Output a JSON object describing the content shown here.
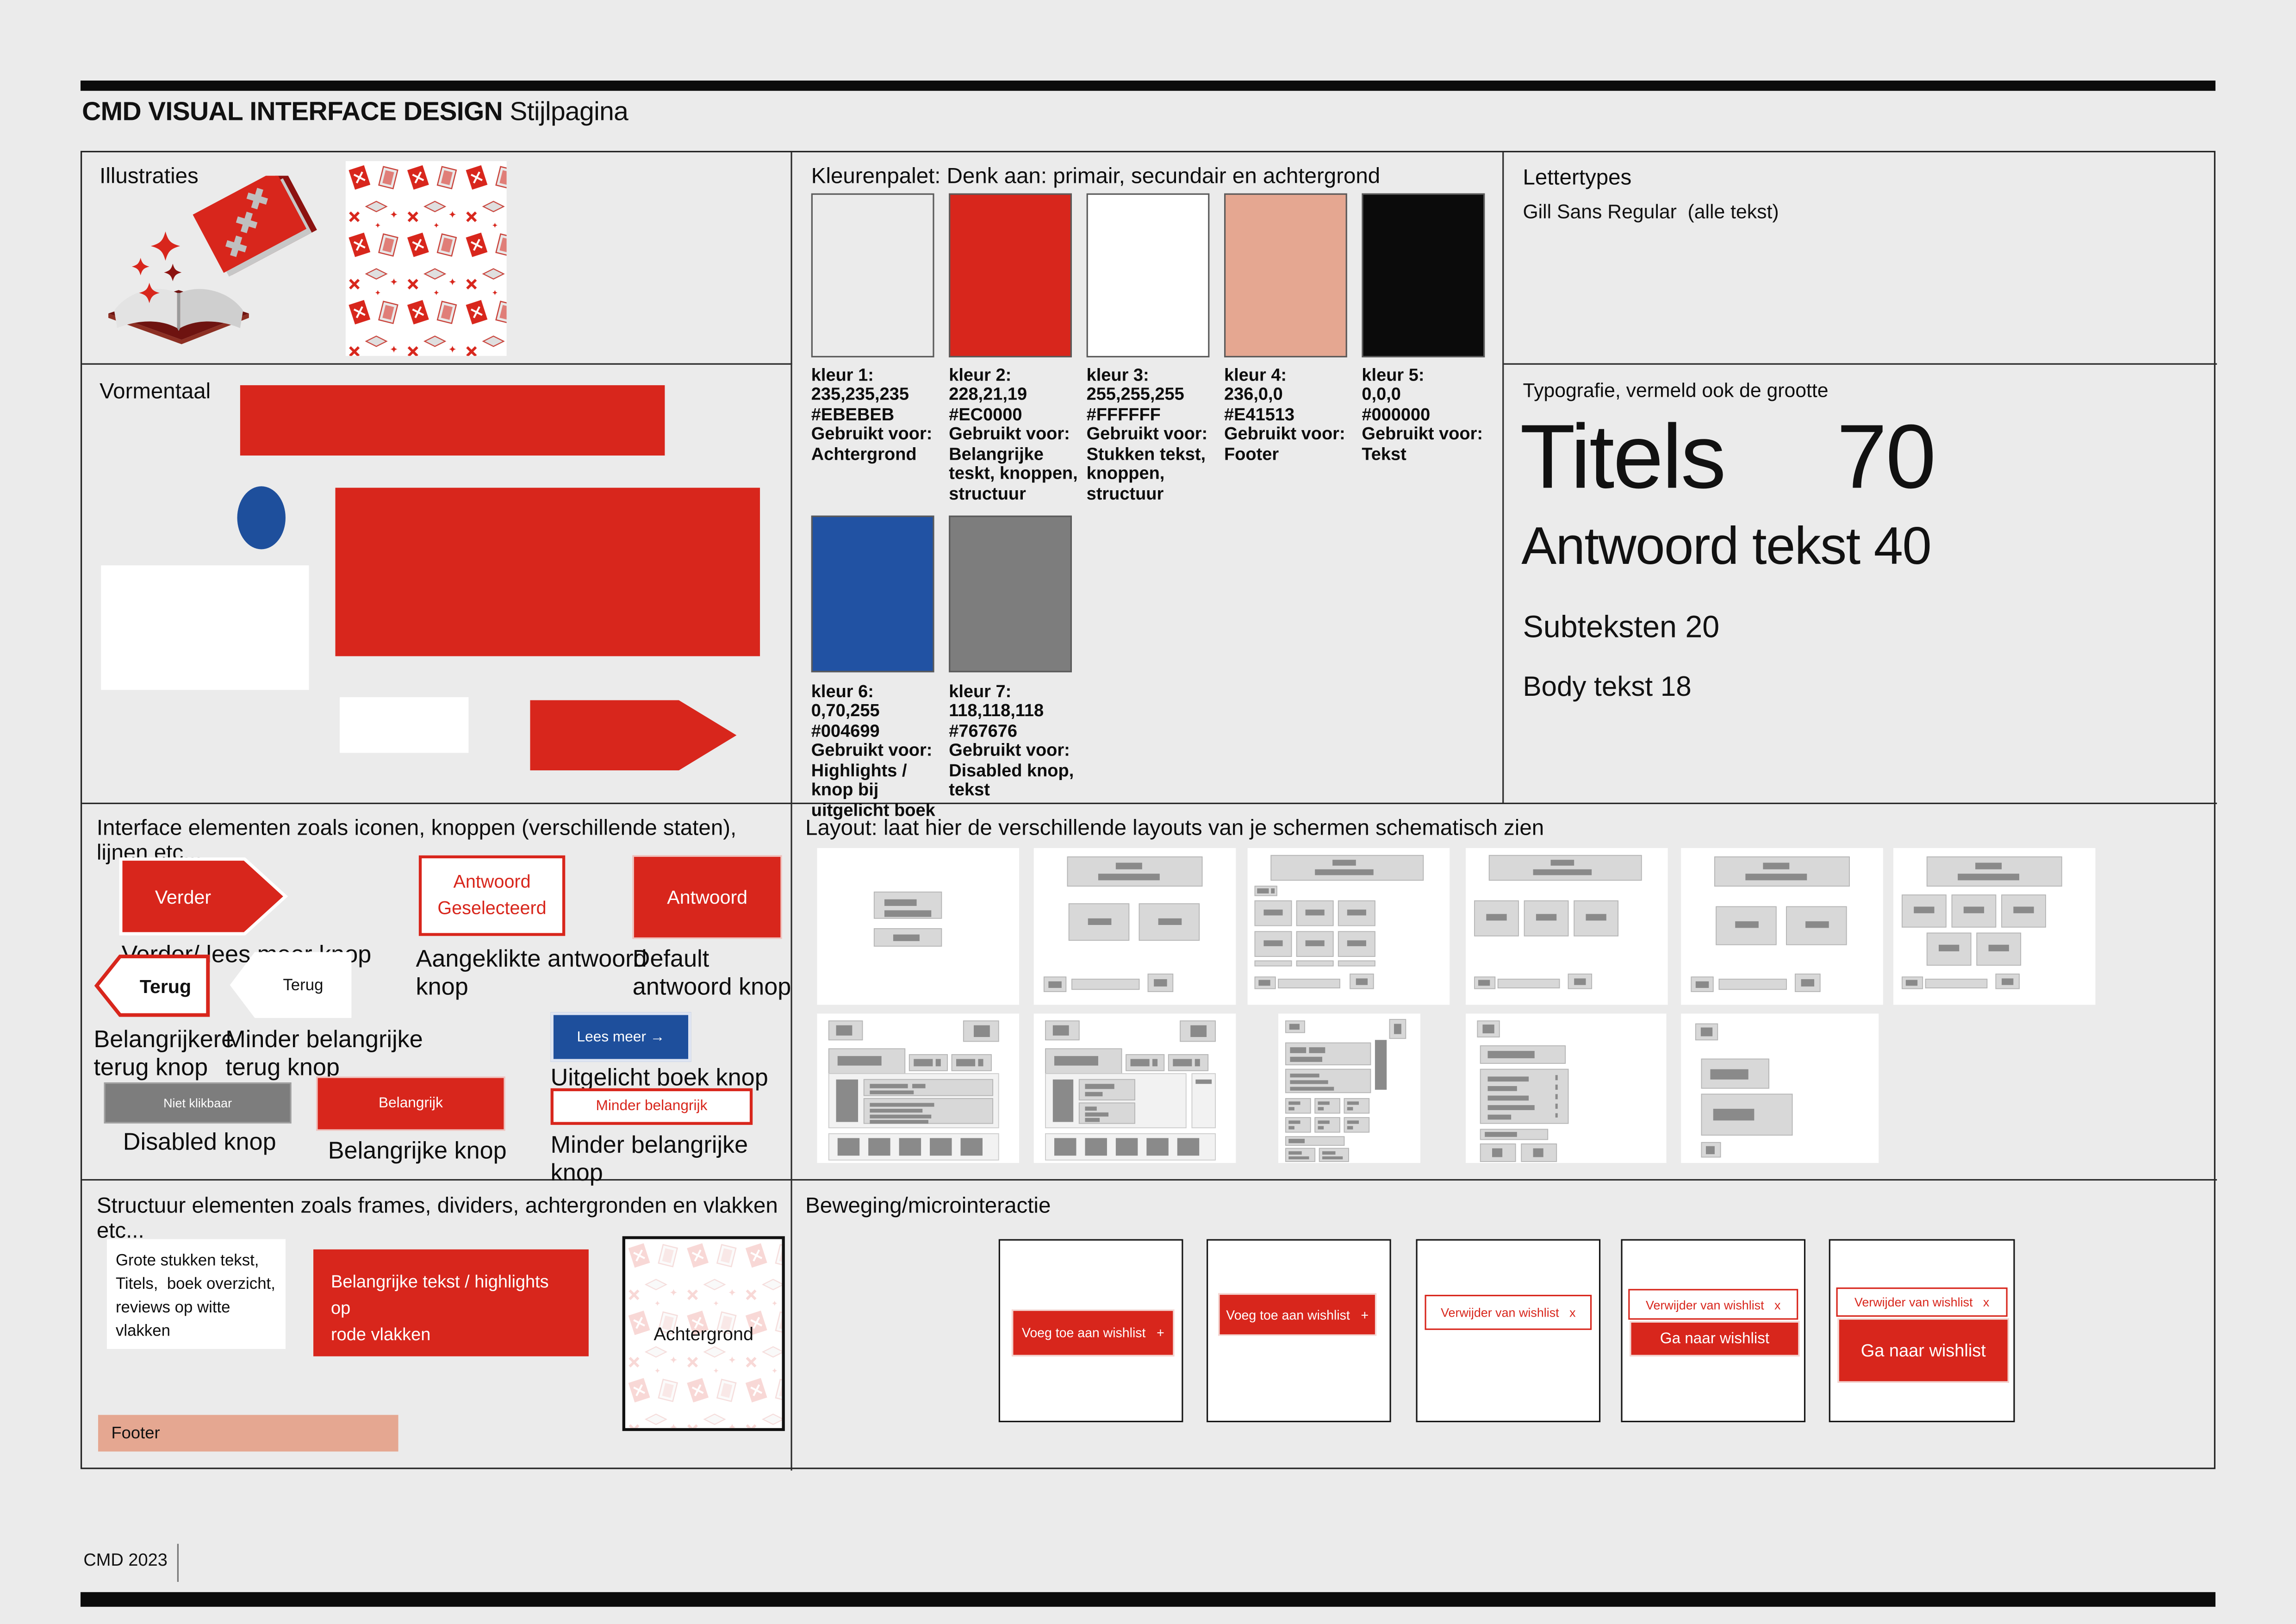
{
  "header": {
    "title_bold": "CMD VISUAL INTERFACE DESIGN",
    "title_rest": "Stijlpagina"
  },
  "footer": {
    "text": "CMD 2023"
  },
  "palette_colors": {
    "red": "#D8261C",
    "blue": "#1E4F9C",
    "salmon": "#E5A791",
    "disabled_gray": "#7D7D7D",
    "background": "#EBEBEB",
    "black": "#0B0B0B"
  },
  "illustraties": {
    "label": "Illustraties"
  },
  "vormentaal": {
    "label": "Vormentaal"
  },
  "kleurenpalet": {
    "label": "Kleurenpalet: Denk aan: primair, secundair en achtergrond",
    "swatches": [
      {
        "name": "kleur 1:",
        "rgb": "235,235,235",
        "hex": "#EBEBEB",
        "used_label": "Gebruikt voor:",
        "used": "Achtergrond",
        "fill": "#EBEBEB"
      },
      {
        "name": "kleur 2:",
        "rgb": "228,21,19",
        "hex": "#EC0000",
        "used_label": "Gebruikt voor:",
        "used": "Belangrijke teskt, knoppen, structuur",
        "fill": "#D8261C"
      },
      {
        "name": "kleur 3:",
        "rgb": "255,255,255",
        "hex": "#FFFFFF",
        "used_label": "Gebruikt voor:",
        "used": "Stukken tekst, knoppen, structuur",
        "fill": "#FFFFFF"
      },
      {
        "name": "kleur 4:",
        "rgb": "236,0,0",
        "hex": "#E41513",
        "used_label": "Gebruikt voor:",
        "used": "Footer",
        "fill": "#E5A791"
      },
      {
        "name": "kleur 5:",
        "rgb": "0,0,0",
        "hex": "#000000",
        "used_label": "Gebruikt voor:",
        "used": "Tekst",
        "fill": "#0B0B0B"
      },
      {
        "name": "kleur 6:",
        "rgb": "0,70,255",
        "hex": "#004699",
        "used_label": "Gebruikt voor:",
        "used": "Highlights / knop bij uitgelicht boek",
        "fill": "#2152A3"
      },
      {
        "name": "kleur 7:",
        "rgb": "118,118,118",
        "hex": "#767676",
        "used_label": "Gebruikt voor:",
        "used": "Disabled knop, tekst",
        "fill": "#7D7D7D"
      }
    ]
  },
  "lettertypes": {
    "label": "Lettertypes",
    "font_line": "Gill Sans Regular  (alle tekst)"
  },
  "typografie": {
    "label": "Typografie, vermeld ook de grootte",
    "titels": "Titels  70",
    "antwoord": "Antwoord tekst 40",
    "subteksten": "Subteksten 20",
    "body": "Body tekst 18"
  },
  "interface": {
    "label": "Interface elementen zoals iconen, knoppen (verschillende staten), lijnen etc...",
    "verder": {
      "button": "Verder",
      "caption": "Verder/ lees meer knop"
    },
    "antwoord_selected": {
      "button": "Antwoord Geselecteerd",
      "caption": "Aangeklikte antwoord knop"
    },
    "antwoord_default": {
      "button": "Antwoord",
      "caption": "Default antwoord knop"
    },
    "terug_primary": {
      "button": "Terug",
      "caption": "Belangrijkere terug knop"
    },
    "terug_secondary": {
      "button": "Terug",
      "caption": "Minder belangrijke terug knop"
    },
    "lees_meer": {
      "button": "Lees meer →",
      "caption": "Uitgelicht boek knop"
    },
    "disabled": {
      "button": "Niet klikbaar",
      "caption": "Disabled knop"
    },
    "belangrijk": {
      "button": "Belangrijk",
      "caption": "Belangrijke knop"
    },
    "minder_belangrijk": {
      "button": "Minder belangrijk",
      "caption": "Minder belangrijke knop"
    }
  },
  "layout": {
    "label": "Layout: laat hier de verschillende layouts van je schermen schematisch zien"
  },
  "structuur": {
    "label": "Structuur elementen zoals frames, dividers, achtergronden en vlakken  etc...",
    "white_box": "Grote stukken tekst,\nTitels,  boek overzicht,\nreviews op witte vlakken",
    "red_box": "Belangrijke tekst / highlights op\nrode vlakken",
    "footer_box": "Footer",
    "background_box": "Achtergrond"
  },
  "beweging": {
    "label": "Beweging/microinteractie",
    "add_wishlist": "Voeg toe aan wishlist   +",
    "remove_wishlist": "Verwijder van wishlist   x",
    "goto_wishlist": "Ga naar wishlist"
  }
}
